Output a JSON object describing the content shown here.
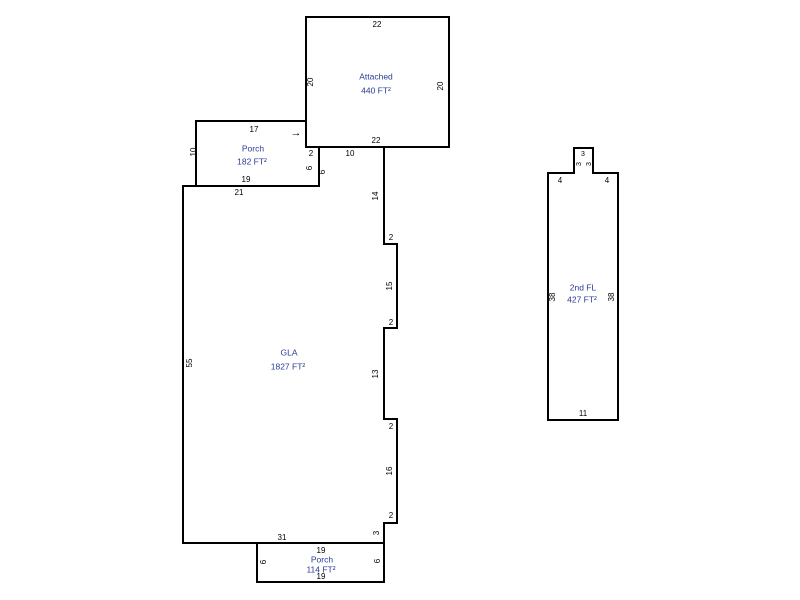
{
  "sketch": {
    "background_color": "#ffffff",
    "wall_color": "#000000",
    "dim_text_color": "#000000",
    "area_text_color": "#2b3a96"
  },
  "shapes": [
    {
      "name": "attached-garage",
      "points": "306,17 449,17 449,147 306,147"
    },
    {
      "name": "front-porch",
      "points": "196,121 306,121 306,147 319,147 319,186 196,186"
    },
    {
      "name": "gla",
      "points": "183,186 319,186 319,147 384,147 384,244 397,244 397,328 384,328 384,419 397,419 397,523 384,523 384,543 183,543"
    },
    {
      "name": "rear-porch",
      "points": "257,543 384,543 384,582 257,582"
    },
    {
      "name": "second-floor",
      "points": "548,173 574,173 574,148 593,148 593,173 618,173 618,420 548,420"
    }
  ],
  "labels": [
    {
      "name": "garage-top-dim",
      "text": "22",
      "x": 377,
      "y": 25,
      "kind": "dim"
    },
    {
      "name": "garage-left-dim",
      "text": "20",
      "x": 311,
      "y": 82,
      "kind": "dim",
      "rot": -90
    },
    {
      "name": "garage-right-dim",
      "text": "20",
      "x": 441,
      "y": 86,
      "kind": "dim",
      "rot": -90
    },
    {
      "name": "garage-bottom-dim",
      "text": "22",
      "x": 376,
      "y": 141,
      "kind": "dim"
    },
    {
      "name": "garage-area-label",
      "text": "Attached",
      "x": 376,
      "y": 77,
      "kind": "area"
    },
    {
      "name": "garage-area-value",
      "text": "440 FT²",
      "x": 376,
      "y": 91,
      "kind": "area"
    },
    {
      "name": "front-porch-top-dim",
      "text": "17",
      "x": 254,
      "y": 130,
      "kind": "dim"
    },
    {
      "name": "front-porch-left-dim",
      "text": "10",
      "x": 194,
      "y": 152,
      "kind": "dim",
      "rot": -90
    },
    {
      "name": "front-porch-area-label",
      "text": "Porch",
      "x": 253,
      "y": 149,
      "kind": "area"
    },
    {
      "name": "front-porch-area-value",
      "text": "182 FT²",
      "x": 252,
      "y": 162,
      "kind": "area"
    },
    {
      "name": "front-porch-bottom-dim",
      "text": "19",
      "x": 246,
      "y": 180,
      "kind": "dim"
    },
    {
      "name": "front-porch-step-dim",
      "text": "2",
      "x": 311,
      "y": 154,
      "kind": "dim"
    },
    {
      "name": "front-porch-right-dim",
      "text": "6",
      "x": 310,
      "y": 168,
      "kind": "dim",
      "rot": -90
    },
    {
      "name": "gla-notch-dim",
      "text": "6",
      "x": 323,
      "y": 172,
      "kind": "dim",
      "rot": -90
    },
    {
      "name": "entry-arrow",
      "text": "→",
      "x": 296,
      "y": 133,
      "kind": "arrow"
    },
    {
      "name": "gla-top-dim",
      "text": "21",
      "x": 239,
      "y": 193,
      "kind": "dim"
    },
    {
      "name": "gla-upper-dim",
      "text": "10",
      "x": 350,
      "y": 154,
      "kind": "dim"
    },
    {
      "name": "gla-right-dim-1",
      "text": "14",
      "x": 376,
      "y": 196,
      "kind": "dim",
      "rot": -90
    },
    {
      "name": "gla-step-dim-1",
      "text": "2",
      "x": 391,
      "y": 238,
      "kind": "dim"
    },
    {
      "name": "gla-right-dim-2",
      "text": "15",
      "x": 390,
      "y": 286,
      "kind": "dim",
      "rot": -90
    },
    {
      "name": "gla-step-dim-2",
      "text": "2",
      "x": 391,
      "y": 323,
      "kind": "dim"
    },
    {
      "name": "gla-right-dim-3",
      "text": "13",
      "x": 376,
      "y": 374,
      "kind": "dim",
      "rot": -90
    },
    {
      "name": "gla-step-dim-3",
      "text": "2",
      "x": 391,
      "y": 427,
      "kind": "dim"
    },
    {
      "name": "gla-right-dim-4",
      "text": "16",
      "x": 390,
      "y": 471,
      "kind": "dim",
      "rot": -90
    },
    {
      "name": "gla-step-dim-4",
      "text": "2",
      "x": 391,
      "y": 516,
      "kind": "dim"
    },
    {
      "name": "gla-right-dim-5",
      "text": "3",
      "x": 377,
      "y": 533,
      "kind": "dim",
      "rot": -90
    },
    {
      "name": "gla-bottom-dim",
      "text": "31",
      "x": 282,
      "y": 538,
      "kind": "dim"
    },
    {
      "name": "gla-left-dim",
      "text": "55",
      "x": 190,
      "y": 363,
      "kind": "dim",
      "rot": -90
    },
    {
      "name": "gla-area-label",
      "text": "GLA",
      "x": 289,
      "y": 353,
      "kind": "area"
    },
    {
      "name": "gla-area-value",
      "text": "1827 FT²",
      "x": 288,
      "y": 367,
      "kind": "area"
    },
    {
      "name": "rear-porch-top-dim",
      "text": "19",
      "x": 321,
      "y": 551,
      "kind": "dim"
    },
    {
      "name": "rear-porch-area-label",
      "text": "Porch",
      "x": 322,
      "y": 560,
      "kind": "area"
    },
    {
      "name": "rear-porch-area-value",
      "text": "114 FT²",
      "x": 321,
      "y": 570,
      "kind": "area"
    },
    {
      "name": "rear-porch-bottom-dim",
      "text": "19",
      "x": 321,
      "y": 577,
      "kind": "dim"
    },
    {
      "name": "rear-porch-left-dim",
      "text": "6",
      "x": 264,
      "y": 562,
      "kind": "dim",
      "rot": -90
    },
    {
      "name": "rear-porch-right-dim",
      "text": "6",
      "x": 378,
      "y": 561,
      "kind": "dim",
      "rot": -90
    },
    {
      "name": "second-floor-bump-top-dim",
      "text": "3",
      "x": 583,
      "y": 154,
      "kind": "dimsm"
    },
    {
      "name": "second-floor-bump-left-dim",
      "text": "3",
      "x": 579,
      "y": 164,
      "kind": "dimsm",
      "rot": -90
    },
    {
      "name": "second-floor-bump-right-dim",
      "text": "3",
      "x": 589,
      "y": 164,
      "kind": "dimsm",
      "rot": -90
    },
    {
      "name": "second-floor-left-shoulder-dim",
      "text": "4",
      "x": 560,
      "y": 181,
      "kind": "dim"
    },
    {
      "name": "second-floor-right-shoulder-dim",
      "text": "4",
      "x": 607,
      "y": 181,
      "kind": "dim"
    },
    {
      "name": "second-floor-left-dim",
      "text": "38",
      "x": 553,
      "y": 297,
      "kind": "dim",
      "rot": -90
    },
    {
      "name": "second-floor-right-dim",
      "text": "38",
      "x": 612,
      "y": 297,
      "kind": "dim",
      "rot": -90
    },
    {
      "name": "second-floor-area-label",
      "text": "2nd FL",
      "x": 583,
      "y": 288,
      "kind": "area"
    },
    {
      "name": "second-floor-area-value",
      "text": "427 FT²",
      "x": 582,
      "y": 300,
      "kind": "area"
    },
    {
      "name": "second-floor-bottom-dim",
      "text": "11",
      "x": 583,
      "y": 414,
      "kind": "dim"
    }
  ]
}
